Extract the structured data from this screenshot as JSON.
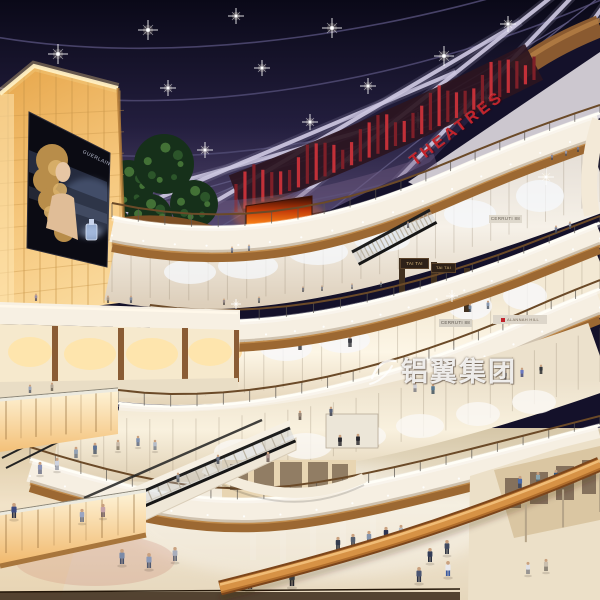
{
  "image": {
    "type": "architectural-rendering",
    "subject": "Multi-level shopping mall atrium at night: dark glazed skylight with radiating beams and spotlights, amber backlit panel wall with perfume billboard, curved cream balconies with wood trim, red cinema signage, escalators and shoppers on a reflective marble floor",
    "width": 600,
    "height": 600
  },
  "signs": {
    "theatres": "THEATRES",
    "tai_tai_1": "TAI TAI",
    "tai_tai_2": "TAI TAI",
    "cerruti_upper": "CERRUTI 88",
    "cerruti_lower": "CERRUTI 88",
    "brand_red": "ALANNAH HILL",
    "billboard_brand": "GUERLAIN"
  },
  "watermark": {
    "text": "铝翼集团"
  },
  "palette": {
    "skylight": "#16132b",
    "beam": "#cdc7e0",
    "theatre_red": "#c2232b",
    "lightbox_amber": "#f6c87e",
    "balcony_cream": "#f6efe2",
    "wood": "#a9713a",
    "floor": "#ecdfc8",
    "fire_screen": "#ff8818"
  }
}
